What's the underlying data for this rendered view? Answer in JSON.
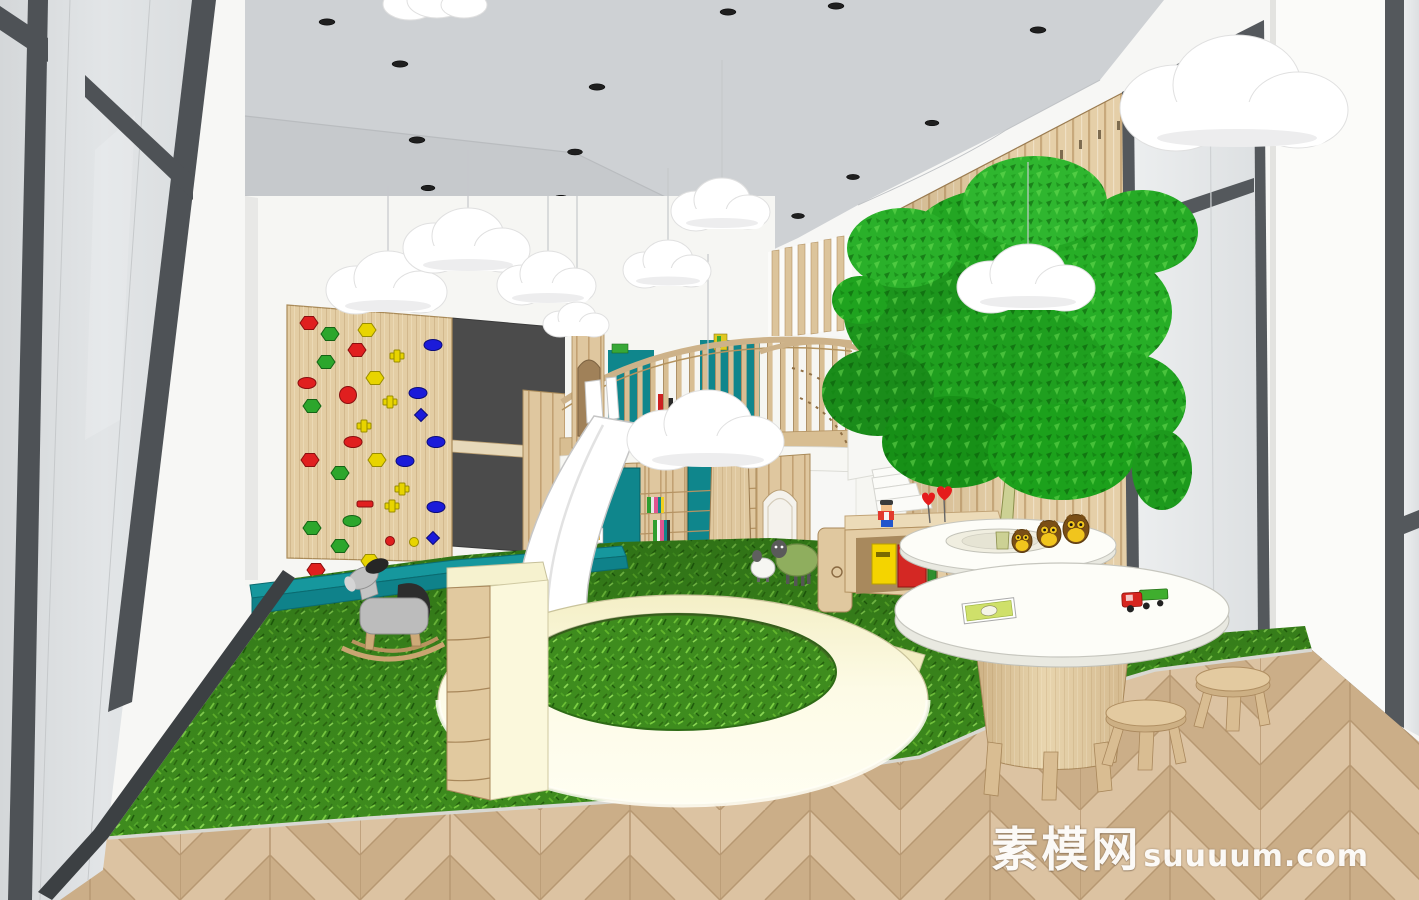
{
  "meta": {
    "domain": "Natural-Image",
    "type": "3D interior rendering (SketchUp style)",
    "subject": "Children's indoor playroom with climbing wall, slide, play loft, indoor tree and reading corner"
  },
  "watermark": {
    "cn": "素模网",
    "latin": "suuuum.com"
  },
  "palette": {
    "ceiling_gray": "#ced1d4",
    "wall_white": "#f7f7f5",
    "wood_light": "#e4cea7",
    "wood_mid": "#dcc49b",
    "wood_dark": "#c8a97a",
    "grass_green": "#3e8c1e",
    "teal": "#11858b",
    "cream": "#fbf8dc",
    "chalkboard_gray": "#4b4b4b",
    "frame_gray": "#4e5256",
    "glass_gray": "#dfe2e4",
    "tree_green": "#1f9e1f",
    "slide_white": "#ffffff",
    "hold_red": "#e01f1f",
    "hold_green": "#2ca62c",
    "hold_yellow": "#e8d400",
    "hold_blue": "#1b1bd9",
    "owl_brown": "#7a4f16",
    "owl_yellow": "#f1c51d",
    "heart_red": "#e51c1c",
    "bin_yellow": "#f4d400",
    "bin_red": "#d42824",
    "floor_plank_light": "#dcc3a2",
    "floor_plank_dark": "#cbae88"
  },
  "scene": {
    "architecture": [
      "black-framed glass partition",
      "gray ceiling with recessed spotlights",
      "vertical wood slat feature wall",
      "floor-to-ceiling windows",
      "herringbone wood floor",
      "artificial grass play carpet",
      "play loft with curved slat balcony",
      "spiral staircase",
      "arched doorways"
    ],
    "play_equipment": [
      "rock climbing wall with colored holds",
      "dark chalkboard panels",
      "teal crash mat",
      "white curved slide",
      "circular cream play ring",
      "drawer storage cabinet"
    ],
    "furniture": [
      "tree planter ring table with owl figurines",
      "round white activity table",
      "wooden mushroom stools",
      "toy storage counter with bins",
      "white step blocks"
    ],
    "toys": [
      "gray rocking horse",
      "green and white sheep figures",
      "red toy truck",
      "picture book",
      "mini figure",
      "red heart decorations",
      "hanging cloud lamps"
    ],
    "plants": [
      "large indoor tree"
    ]
  }
}
